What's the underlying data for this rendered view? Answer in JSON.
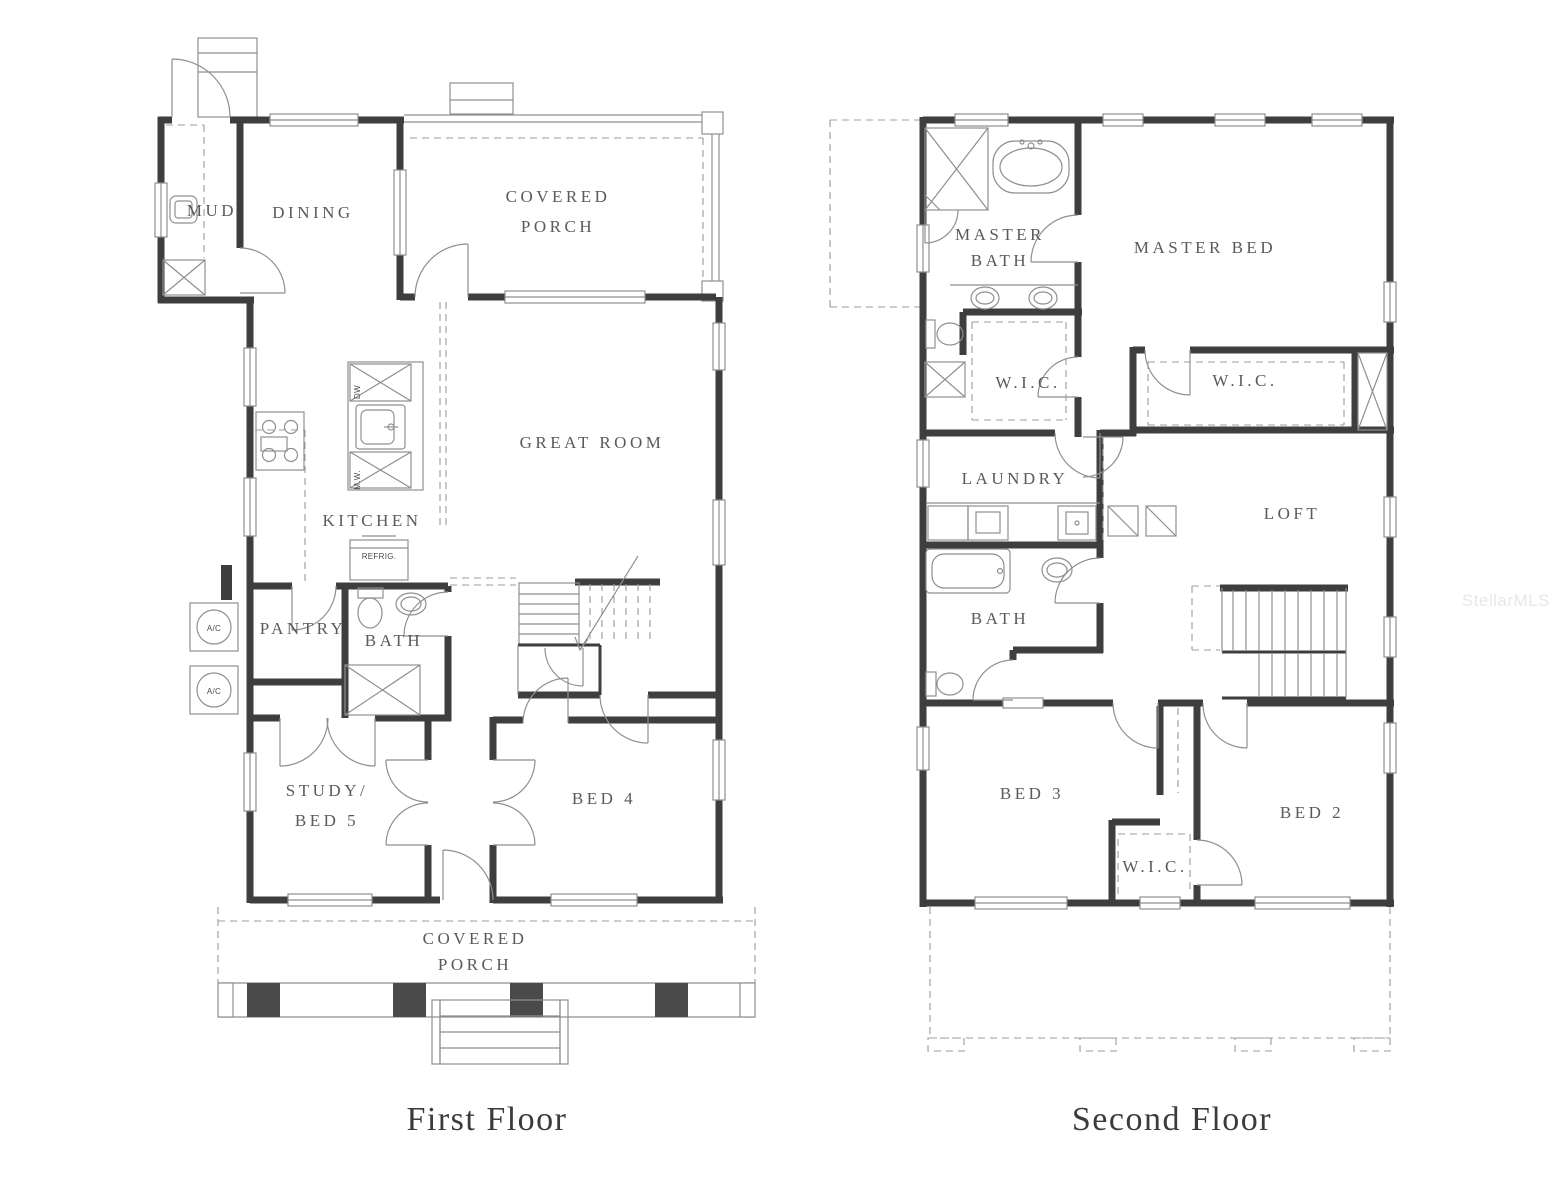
{
  "colors": {
    "background": "#ffffff",
    "frame_border": "#c8c8c8",
    "wall": "#3e3e3e",
    "thin_line": "#8f8f8f",
    "dashed_line": "#9c9c9c",
    "room_label": "#5a5a5a",
    "floor_title": "#3b3b3b",
    "watermark": "#e7e7e7"
  },
  "watermark": {
    "text": "StellarMLS"
  },
  "first_floor": {
    "title": "First Floor",
    "rooms": {
      "mud": "MUD",
      "dining": "DINING",
      "covered_porch_top_line1": "COVERED",
      "covered_porch_top_line2": "PORCH",
      "great_room": "GREAT ROOM",
      "kitchen": "KITCHEN",
      "pantry": "PANTRY",
      "bath": "BATH",
      "study_line1": "STUDY/",
      "study_line2": "BED 5",
      "bed4": "BED 4",
      "covered_porch_bottom_line1": "COVERED",
      "covered_porch_bottom_line2": "PORCH"
    },
    "appliances": {
      "dw": "DW",
      "mw": "M.W.",
      "refrig": "REFRIG.",
      "ac": "A/C"
    }
  },
  "second_floor": {
    "title": "Second Floor",
    "rooms": {
      "master_bath_line1": "MASTER",
      "master_bath_line2": "BATH",
      "master_bed": "MASTER BED",
      "wic_master_left": "W.I.C.",
      "wic_master_right": "W.I.C.",
      "laundry": "LAUNDRY",
      "loft": "LOFT",
      "bath": "BATH",
      "bed3": "BED 3",
      "bed2": "BED 2",
      "wic_bed2": "W.I.C."
    }
  }
}
